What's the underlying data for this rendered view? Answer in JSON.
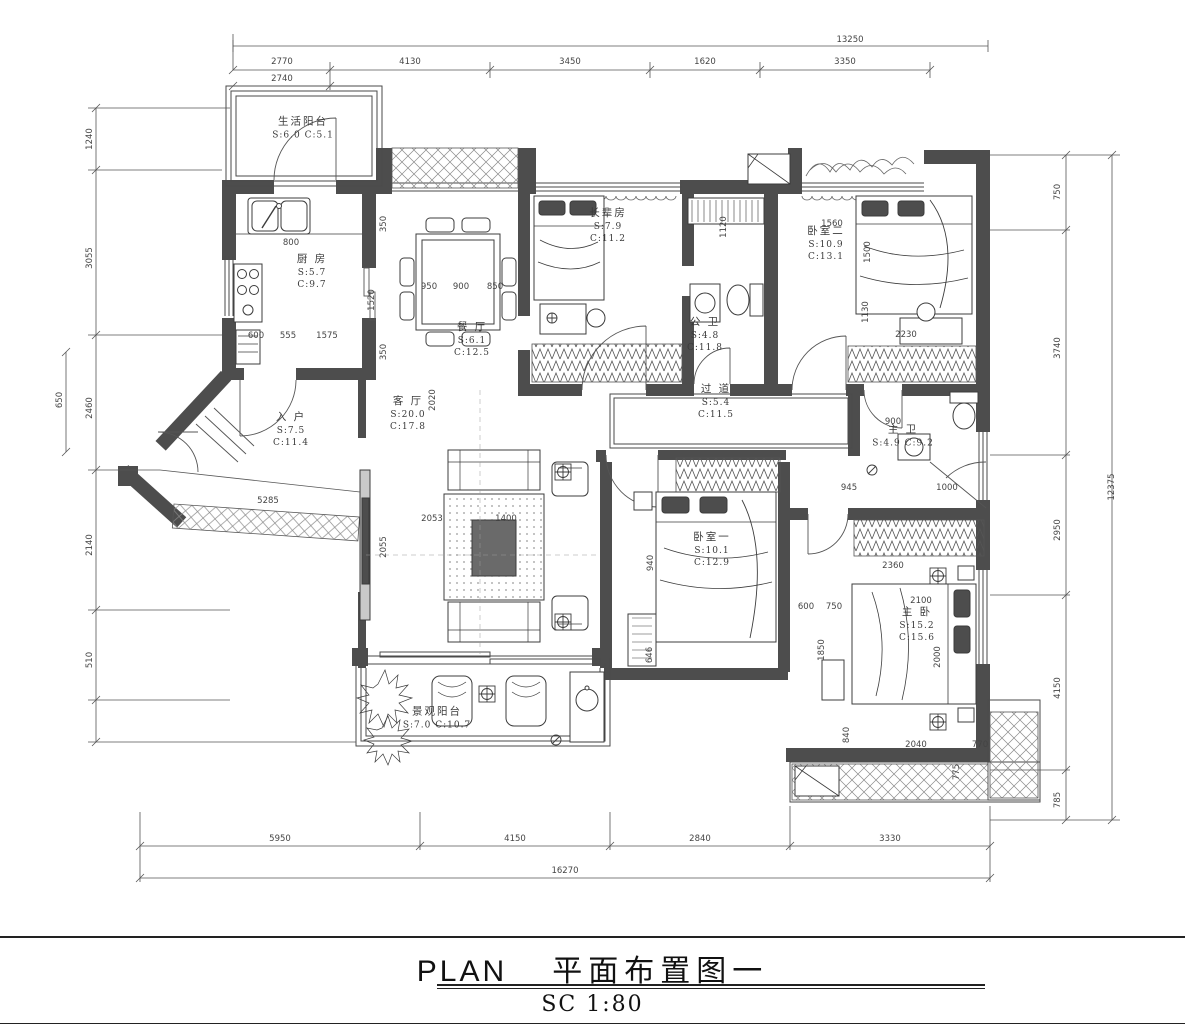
{
  "title": {
    "plan_label": "PLAN",
    "plan_name": "平面布置图一",
    "scale": "SC 1:80"
  },
  "rooms": [
    {
      "id": "service-balcony",
      "x": 303,
      "y": 128,
      "lines": [
        "生活阳台",
        "S:6.0 C:5.1"
      ]
    },
    {
      "id": "kitchen",
      "x": 312,
      "y": 272,
      "lines": [
        "厨 房",
        "S:5.7",
        "C:9.7"
      ]
    },
    {
      "id": "dining",
      "x": 472,
      "y": 340,
      "lines": [
        "餐 厅",
        "S:6.1",
        "C:12.5"
      ]
    },
    {
      "id": "elder-room",
      "x": 608,
      "y": 226,
      "lines": [
        "长辈房",
        "S:7.9",
        "C:11.2"
      ]
    },
    {
      "id": "public-bath",
      "x": 705,
      "y": 335,
      "lines": [
        "公 卫",
        "S:4.8",
        "C:11.8"
      ]
    },
    {
      "id": "bedroom-2",
      "x": 826,
      "y": 244,
      "lines": [
        "卧室二",
        "S:10.9",
        "C:13.1"
      ]
    },
    {
      "id": "entry",
      "x": 291,
      "y": 430,
      "lines": [
        "入 户",
        "S:7.5",
        "C:11.4"
      ]
    },
    {
      "id": "living",
      "x": 408,
      "y": 414,
      "lines": [
        "客 厅",
        "S:20.0",
        "C:17.8"
      ]
    },
    {
      "id": "corridor",
      "x": 716,
      "y": 402,
      "lines": [
        "过 道",
        "S:5.4",
        "C:11.5"
      ]
    },
    {
      "id": "master-bath",
      "x": 903,
      "y": 436,
      "lines": [
        "主 卫",
        "S:4.9 C:9.2"
      ]
    },
    {
      "id": "bedroom-1",
      "x": 712,
      "y": 550,
      "lines": [
        "卧室一",
        "S:10.1",
        "C:12.9"
      ]
    },
    {
      "id": "master-bedroom",
      "x": 917,
      "y": 625,
      "lines": [
        "主 卧",
        "S:15.2",
        "C:15.6"
      ]
    },
    {
      "id": "view-balcony",
      "x": 437,
      "y": 718,
      "lines": [
        "景观阳台",
        "S:7.0 C:10.7"
      ]
    }
  ],
  "dimensions": [
    {
      "t": "13250",
      "x": 850,
      "y": 40
    },
    {
      "t": "2770",
      "x": 282,
      "y": 62
    },
    {
      "t": "4130",
      "x": 410,
      "y": 62
    },
    {
      "t": "3450",
      "x": 570,
      "y": 62
    },
    {
      "t": "1620",
      "x": 705,
      "y": 62
    },
    {
      "t": "3350",
      "x": 845,
      "y": 62
    },
    {
      "t": "2740",
      "x": 282,
      "y": 79
    },
    {
      "t": "5950",
      "x": 280,
      "y": 839
    },
    {
      "t": "4150",
      "x": 515,
      "y": 839
    },
    {
      "t": "2840",
      "x": 700,
      "y": 839
    },
    {
      "t": "3330",
      "x": 890,
      "y": 839
    },
    {
      "t": "16270",
      "x": 565,
      "y": 871
    },
    {
      "t": "1240",
      "x": 90,
      "y": 139,
      "r": -90
    },
    {
      "t": "3055",
      "x": 90,
      "y": 258,
      "r": -90
    },
    {
      "t": "2460",
      "x": 90,
      "y": 408,
      "r": -90
    },
    {
      "t": "2140",
      "x": 90,
      "y": 545,
      "r": -90
    },
    {
      "t": "510",
      "x": 90,
      "y": 660,
      "r": -90
    },
    {
      "t": "650",
      "x": 60,
      "y": 400,
      "r": -90
    },
    {
      "t": "750",
      "x": 1058,
      "y": 192,
      "r": -90
    },
    {
      "t": "3740",
      "x": 1058,
      "y": 348,
      "r": -90
    },
    {
      "t": "2950",
      "x": 1058,
      "y": 530,
      "r": -90
    },
    {
      "t": "4150",
      "x": 1058,
      "y": 688,
      "r": -90
    },
    {
      "t": "785",
      "x": 1058,
      "y": 800,
      "r": -90
    },
    {
      "t": "12375",
      "x": 1112,
      "y": 487,
      "r": -90
    },
    {
      "t": "800",
      "x": 291,
      "y": 243
    },
    {
      "t": "600",
      "x": 256,
      "y": 336
    },
    {
      "t": "555",
      "x": 288,
      "y": 336
    },
    {
      "t": "1575",
      "x": 327,
      "y": 336
    },
    {
      "t": "1520",
      "x": 372,
      "y": 300,
      "r": -90
    },
    {
      "t": "350",
      "x": 384,
      "y": 224,
      "r": -90
    },
    {
      "t": "350",
      "x": 384,
      "y": 352,
      "r": -90
    },
    {
      "t": "950",
      "x": 429,
      "y": 287
    },
    {
      "t": "900",
      "x": 461,
      "y": 287
    },
    {
      "t": "850",
      "x": 495,
      "y": 287
    },
    {
      "t": "2020",
      "x": 433,
      "y": 400,
      "r": -90
    },
    {
      "t": "2053",
      "x": 432,
      "y": 519
    },
    {
      "t": "1400",
      "x": 506,
      "y": 519
    },
    {
      "t": "2055",
      "x": 384,
      "y": 547,
      "r": -90
    },
    {
      "t": "5285",
      "x": 268,
      "y": 501
    },
    {
      "t": "1560",
      "x": 832,
      "y": 224
    },
    {
      "t": "1500",
      "x": 868,
      "y": 252,
      "r": -90
    },
    {
      "t": "1130",
      "x": 866,
      "y": 312,
      "r": -90
    },
    {
      "t": "2230",
      "x": 906,
      "y": 335
    },
    {
      "t": "1120",
      "x": 724,
      "y": 227,
      "r": -90
    },
    {
      "t": "900",
      "x": 893,
      "y": 422
    },
    {
      "t": "945",
      "x": 849,
      "y": 488
    },
    {
      "t": "1000",
      "x": 947,
      "y": 488
    },
    {
      "t": "2360",
      "x": 893,
      "y": 566
    },
    {
      "t": "600",
      "x": 806,
      "y": 607
    },
    {
      "t": "750",
      "x": 834,
      "y": 607
    },
    {
      "t": "2100",
      "x": 921,
      "y": 601
    },
    {
      "t": "2000",
      "x": 938,
      "y": 657,
      "r": -90
    },
    {
      "t": "1850",
      "x": 822,
      "y": 650,
      "r": -90
    },
    {
      "t": "940",
      "x": 651,
      "y": 563,
      "r": -90
    },
    {
      "t": "646",
      "x": 650,
      "y": 655,
      "r": -90
    },
    {
      "t": "2040",
      "x": 916,
      "y": 745
    },
    {
      "t": "770",
      "x": 980,
      "y": 745
    },
    {
      "t": "775",
      "x": 957,
      "y": 772,
      "r": -90
    },
    {
      "t": "840",
      "x": 847,
      "y": 735,
      "r": -90
    }
  ]
}
